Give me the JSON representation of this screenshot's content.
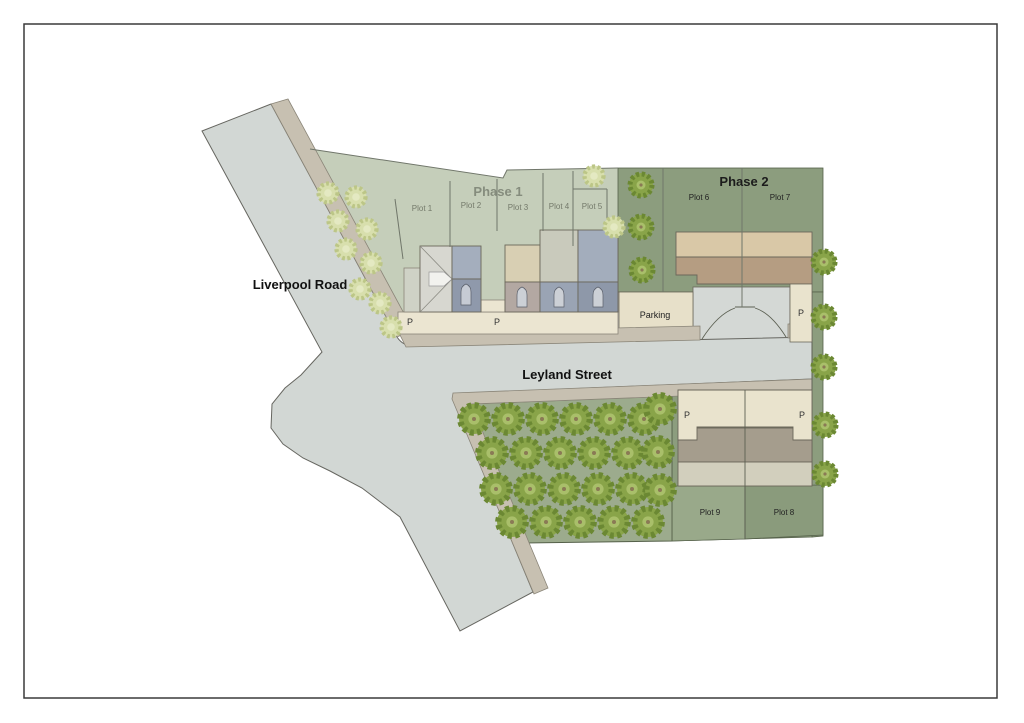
{
  "labels": {
    "liverpool_road": "Liverpool Road",
    "leyland_street": "Leyland Street",
    "phase1_title": "Phase 1",
    "phase2_title": "Phase 2",
    "parking": "Parking",
    "p": "P",
    "phase1_plots": [
      "Plot 1",
      "Plot 2",
      "Plot 3",
      "Plot 4",
      "Plot 5"
    ],
    "phase2_plots_top": [
      "Plot 6",
      "Plot 7"
    ],
    "phase2_plots_bottom": [
      "Plot 9",
      "Plot 8"
    ]
  },
  "colors": {
    "road": "#d2d7d4",
    "sidewalk": "#c7c0b1",
    "phase1_green": "#c5ceba",
    "phase2_green": "#8c9d7e",
    "plot9_green": "#99a98a",
    "plot8_green": "#8a9b7c",
    "orchard_green": "#9cab8d",
    "parking_cream": "#e7e0c9",
    "courtyard_gray": "#d4d8d5",
    "building_tan_light": "#d9c8a7",
    "building_tan_dark": "#b59d82",
    "building_cream": "#e9e3cd",
    "building_band_gray": "#a59d8d",
    "building_band_khaki": "#d2cfbd",
    "tree_dark": "#89a449",
    "tree_pale": "#d8dfad"
  },
  "trees": {
    "orchard": [
      [
        474,
        419
      ],
      [
        508,
        419
      ],
      [
        542,
        419
      ],
      [
        576,
        419
      ],
      [
        610,
        419
      ],
      [
        644,
        419
      ],
      [
        660,
        409
      ],
      [
        492,
        453
      ],
      [
        526,
        453
      ],
      [
        560,
        453
      ],
      [
        594,
        453
      ],
      [
        628,
        453
      ],
      [
        658,
        452
      ],
      [
        496,
        489
      ],
      [
        530,
        489
      ],
      [
        564,
        489
      ],
      [
        598,
        489
      ],
      [
        632,
        489
      ],
      [
        660,
        490
      ],
      [
        512,
        522
      ],
      [
        546,
        522
      ],
      [
        580,
        522
      ],
      [
        614,
        522
      ],
      [
        648,
        522
      ]
    ],
    "phase2_strip": [
      [
        641,
        185
      ],
      [
        641,
        227
      ],
      [
        642,
        270
      ]
    ],
    "right_boundary": [
      [
        824,
        262
      ],
      [
        824,
        317
      ],
      [
        824,
        367
      ],
      [
        825,
        425
      ],
      [
        825,
        474
      ]
    ],
    "roadside_pale": [
      [
        328,
        193
      ],
      [
        356,
        197
      ],
      [
        338,
        221
      ],
      [
        367,
        229
      ],
      [
        346,
        249
      ],
      [
        371,
        263
      ],
      [
        360,
        289
      ],
      [
        380,
        303
      ],
      [
        391,
        327
      ]
    ],
    "top_pale": [
      [
        594,
        176
      ],
      [
        614,
        227
      ]
    ]
  }
}
